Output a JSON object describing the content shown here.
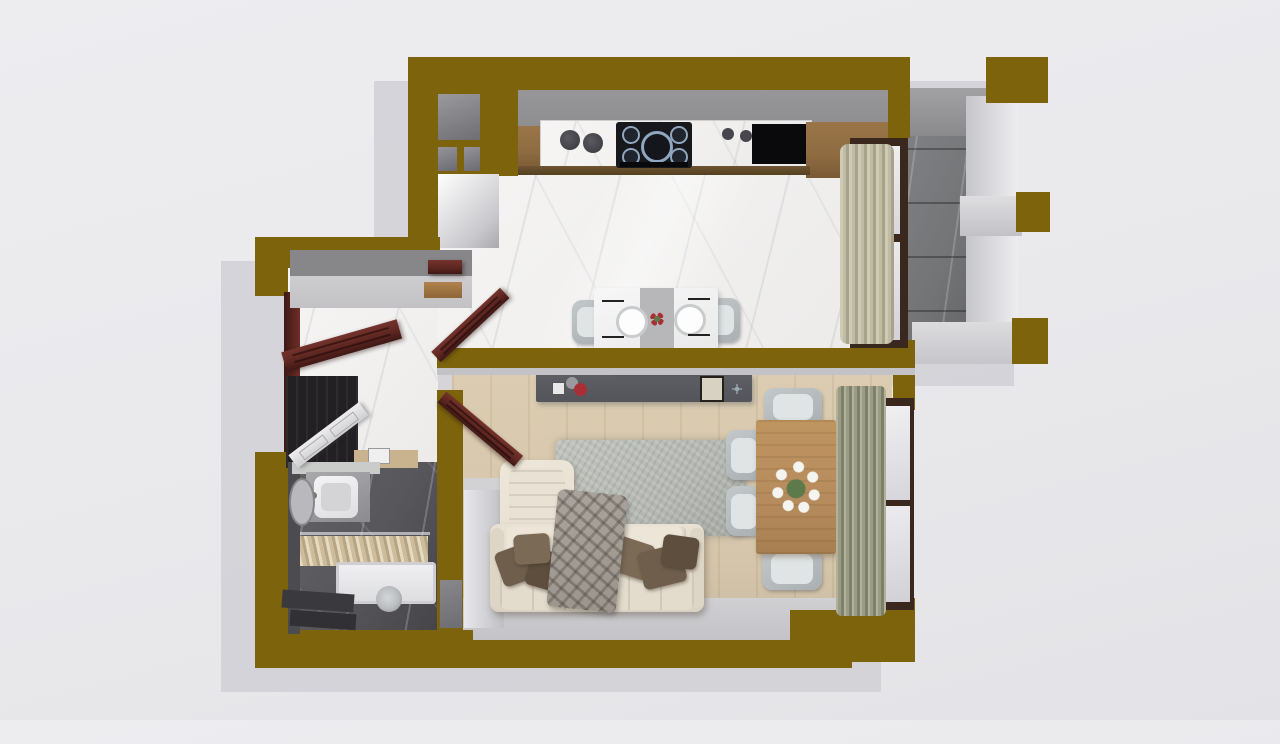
{
  "scene": {
    "description": "top-down 3d render of a one-bedroom apartment floor plan with olive cut walls on a light gray backdrop",
    "text_content": "none (image contains no rendered text)"
  },
  "palette": {
    "bg": "#e9e9ec",
    "shadow": "#cfcfd5",
    "wall": "#7d640c",
    "wallLight": "#8a6f10",
    "marbleBase": "#f0efee",
    "darkMarbleBase": "#57575b",
    "balconyBase": "#737476",
    "woodFloor": "#d5c6ab",
    "woodCounter": "#8e6b41",
    "woodTable": "#b68c5e",
    "grayBand": "#8e8e90",
    "consoleDark": "#53555a",
    "tvBlack": "#141417",
    "sofaCream": "#e8e1d4",
    "sofaCreamDark": "#d9d1c1",
    "pillowBrown": "#6f5e4b",
    "pillowBrownDark": "#5d4e3d",
    "rug": "#b4b7b2",
    "throw": "#9a948b",
    "curtainBeige": "#c0bba4",
    "curtainSage": "#9a9c85",
    "doorMaroon": "#5e2621",
    "doorMaroonDeep": "#3f1815",
    "windowFrame": "#3a281f",
    "glass": "#ebebee",
    "chairGray": "#aab0b2",
    "chairSeat": "#e0e4e4",
    "white": "#ededef",
    "chrome": "#b9bcbf",
    "flowerRed": "#a92f35",
    "leafGreen": "#5d7a4a",
    "flowerWhite": "#f4f4f0",
    "wardrobe": "#232023",
    "shelfTop": "#87878a",
    "shelfFace": "#c2c2c5",
    "nicheGray": "#88888c",
    "wallFaceLight": "#c3c3c7",
    "stepDark": "#3a3a3e",
    "tan": "#c9b38e",
    "stove": "#16181c",
    "burnerRing": "#8fa6c0"
  },
  "rooms": {
    "kitchen": {
      "floor": "white marble",
      "objects": [
        "upper-cabinet-band",
        "counter-wood-left",
        "counter-marble",
        "sink-bowls",
        "gas-stove-5-burner",
        "counter-knobs",
        "black-basin",
        "counter-wood-right",
        "table-for-two",
        "two-plates",
        "red-flower-centerpiece",
        "window-with-beige-curtain"
      ]
    },
    "living_room": {
      "floor": "light wood",
      "objects": [
        "tv-console",
        "wall-mounted-tv",
        "gray-rug",
        "armchair",
        "cream-sofa",
        "brown-pillows",
        "plaid-throw",
        "dining-table-6-chairs",
        "white-flower-centerpiece",
        "window-with-sage-curtain"
      ]
    },
    "hallway": {
      "floor": "white marble",
      "objects": [
        "gray-shelf-unit",
        "entry-door-open",
        "door-to-kitchen-open",
        "door-to-living-open",
        "dark-wardrobe",
        "bathroom-door-open"
      ]
    },
    "bathroom": {
      "floor": "dark marble",
      "objects": [
        "vanity-sink",
        "oval-mirror",
        "shower-mat",
        "bathtub",
        "chrome-drain",
        "marble-steps",
        "wall-niche"
      ]
    },
    "balcony": {
      "floor": "gray marble tiles",
      "objects": [
        "white-parapet-walls",
        "divider-wall",
        "olive-wall-stubs"
      ]
    }
  }
}
